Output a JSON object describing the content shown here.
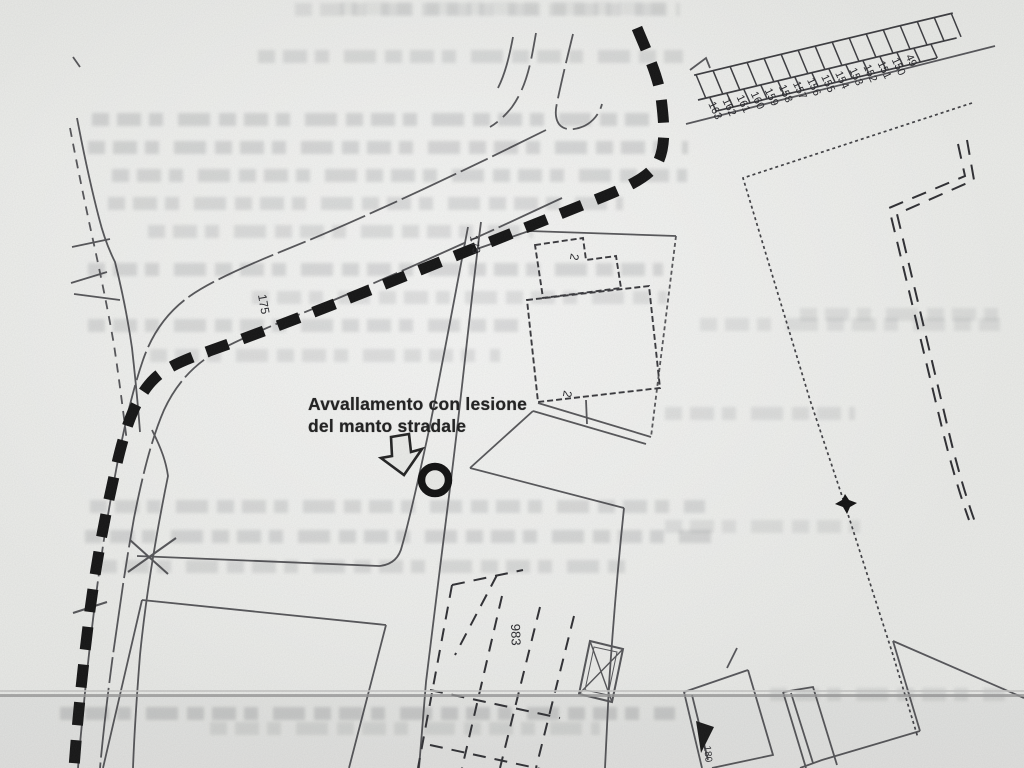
{
  "annotation": {
    "line1": "Avvallamento con lesione",
    "line2": "del manto stradale"
  },
  "map": {
    "road_labels": [
      "175",
      "173"
    ],
    "parcel_strip_numbers": [
      "49",
      "150",
      "151",
      "152",
      "153",
      "154",
      "155",
      "156",
      "157",
      "158",
      "159",
      "160",
      "161",
      "162",
      "163"
    ],
    "parcel_labels": {
      "bottom": "983",
      "bottom_right": "180"
    },
    "building_marks": [
      "2",
      "2"
    ],
    "colors": {
      "ink": "#1a1a1a",
      "paper": "#eaebe8",
      "scan_line": "#9b9b9b"
    }
  }
}
